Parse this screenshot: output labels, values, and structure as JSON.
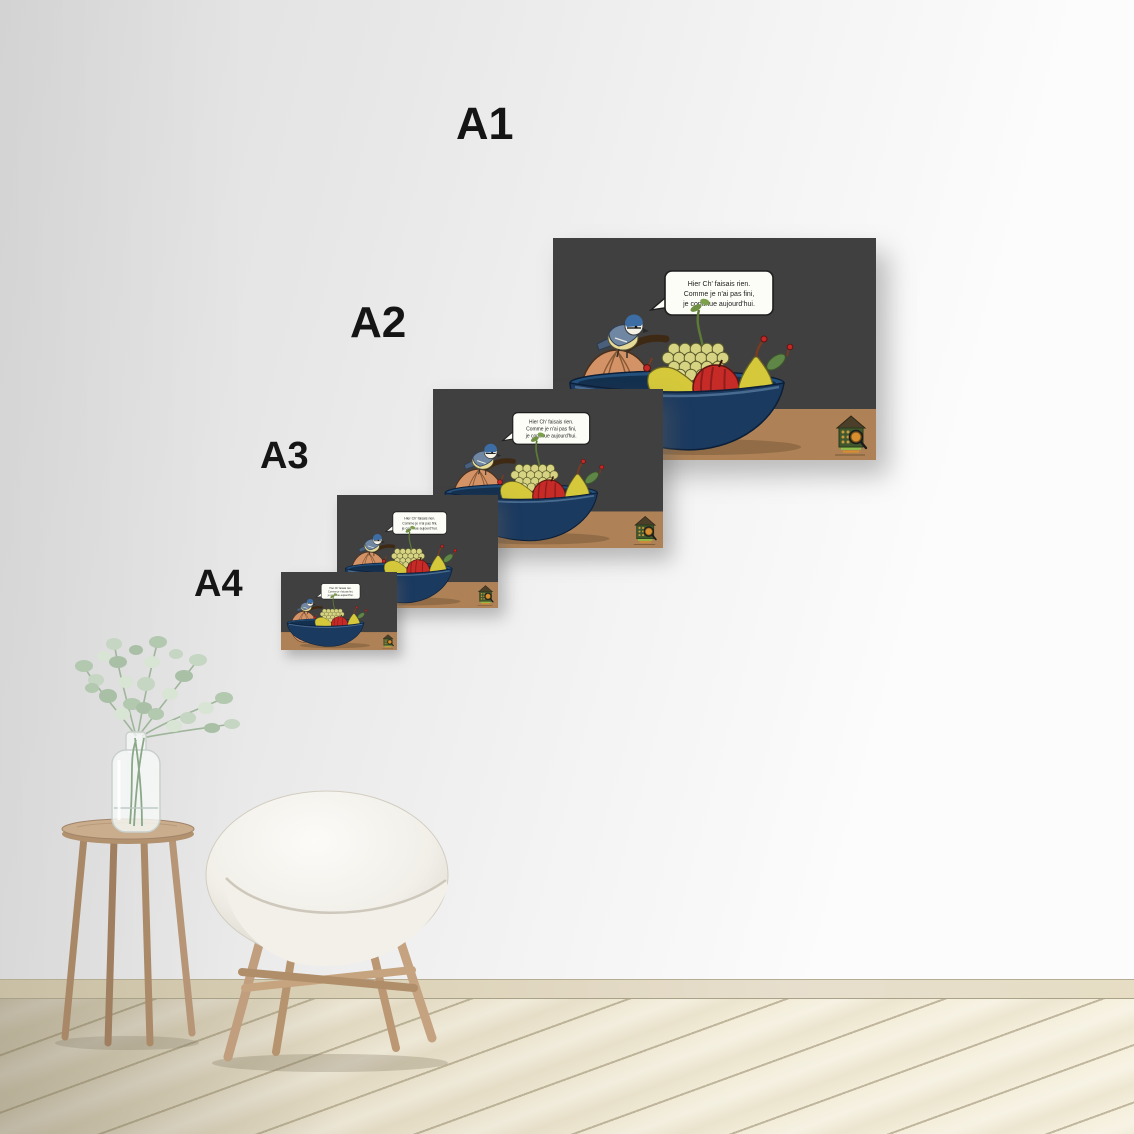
{
  "labels": {
    "a1": "A1",
    "a2": "A2",
    "a3": "A3",
    "a4": "A4"
  },
  "poster": {
    "bubble_line1": "Hier Ch' faisais rien.",
    "bubble_line2": "Comme je n'ai pas fini,",
    "bubble_line3": "je continue aujourd'hui."
  },
  "colors": {
    "poster_background": "#404040",
    "poster_table": "#ae8256",
    "bowl_navy": "#1b3a60",
    "bowl_rim": "#24507c",
    "apple_red": "#c72b28",
    "pear_yellow": "#d5c93b",
    "grape_green": "#d6d383",
    "pumpkin_orange": "#d39367",
    "bird_cap_blue": "#3c6da5",
    "logo_house_green": "#41582f",
    "wall_shade": "#dedede",
    "wall_light": "#fcfcfc",
    "floor_wood": "#f2ecd8",
    "label_text": "#151515"
  }
}
